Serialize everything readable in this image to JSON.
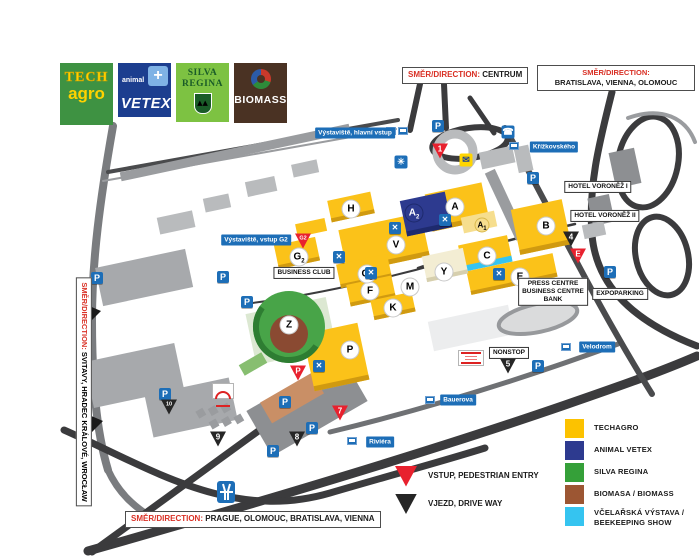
{
  "logos": {
    "techagro": {
      "line1": "TECH",
      "line2": "agro"
    },
    "vetex": {
      "small": "animal",
      "big": "VETEX",
      "cross": "+"
    },
    "silva": {
      "line1": "SILVA",
      "line2": "REGINA",
      "trees": "▲▲"
    },
    "biomass": {
      "text": "BIOMASS"
    }
  },
  "direction_signs": {
    "prefix": "SMĚR/DIRECTION:",
    "top_center": "CENTRUM",
    "top_right": "BRATISLAVA, VIENNA, OLOMOUC",
    "left": "SVITAVY, HRADEC KRÁLOVÉ, WROCŁAW",
    "bottom": "PRAGUE, OLOMOUC, BRATISLAVA, VIENNA"
  },
  "icon_glyphs": {
    "parking": "P",
    "restaurant": "✕",
    "first_aid": "✳",
    "post_office": "✉",
    "phone": "☎"
  },
  "map": {
    "street_labels": [
      {
        "text": "Výstaviště, hlavní vstup",
        "x": 355,
        "y": 133
      },
      {
        "text": "Křížkovského",
        "x": 554,
        "y": 147
      },
      {
        "text": "Výstaviště, vstup G2",
        "x": 256,
        "y": 240
      },
      {
        "text": "Velodrom",
        "x": 597,
        "y": 347
      },
      {
        "text": "Bauerova",
        "x": 458,
        "y": 400
      },
      {
        "text": "Riviéra",
        "x": 380,
        "y": 442
      }
    ],
    "poi_boxes": [
      {
        "id": "hotel-voronez-1",
        "lines": [
          "HOTEL VORONĚŽ I"
        ],
        "x": 598,
        "y": 187
      },
      {
        "id": "hotel-voronez-2",
        "lines": [
          "HOTEL VORONĚŽ II"
        ],
        "x": 605,
        "y": 216
      },
      {
        "id": "press-centre",
        "lines": [
          "PRESS CENTRE",
          "BUSINESS CENTRE",
          "BANK"
        ],
        "x": 553,
        "y": 292
      },
      {
        "id": "expoparking",
        "lines": [
          "EXPOPARKING"
        ],
        "x": 620,
        "y": 294
      },
      {
        "id": "business-club",
        "lines": [
          "BUSINESS CLUB"
        ],
        "x": 304,
        "y": 273
      },
      {
        "id": "nonstop",
        "lines": [
          "NONSTOP"
        ],
        "x": 509,
        "y": 353
      }
    ],
    "halls": [
      {
        "label": "A",
        "sub": "",
        "x": 455,
        "y": 207,
        "kind": "white"
      },
      {
        "label": "A",
        "sub": "1",
        "x": 482,
        "y": 225,
        "kind": "pale"
      },
      {
        "label": "A",
        "sub": "2",
        "x": 414,
        "y": 213,
        "kind": "blue"
      },
      {
        "label": "B",
        "sub": "",
        "x": 546,
        "y": 226,
        "kind": "white"
      },
      {
        "label": "C",
        "sub": "",
        "x": 487,
        "y": 256,
        "kind": "white"
      },
      {
        "label": "E",
        "sub": "",
        "x": 520,
        "y": 277,
        "kind": "white"
      },
      {
        "label": "F",
        "sub": "",
        "x": 370,
        "y": 291,
        "kind": "white"
      },
      {
        "label": "G",
        "sub": "1",
        "x": 367,
        "y": 274,
        "kind": "white"
      },
      {
        "label": "G",
        "sub": "2",
        "x": 299,
        "y": 257,
        "kind": "white"
      },
      {
        "label": "H",
        "sub": "",
        "x": 351,
        "y": 209,
        "kind": "white"
      },
      {
        "label": "K",
        "sub": "",
        "x": 393,
        "y": 308,
        "kind": "white"
      },
      {
        "label": "M",
        "sub": "",
        "x": 410,
        "y": 287,
        "kind": "white"
      },
      {
        "label": "V",
        "sub": "",
        "x": 396,
        "y": 245,
        "kind": "white"
      },
      {
        "label": "Y",
        "sub": "",
        "x": 444,
        "y": 272,
        "kind": "white"
      },
      {
        "label": "Z",
        "sub": "",
        "x": 289,
        "y": 325,
        "kind": "white"
      },
      {
        "label": "P",
        "sub": "",
        "x": 350,
        "y": 350,
        "kind": "white"
      }
    ],
    "entries_red": [
      {
        "label": "1",
        "x": 440,
        "y": 151
      },
      {
        "label": "G2",
        "x": 303,
        "y": 241
      },
      {
        "label": "E",
        "x": 578,
        "y": 256
      },
      {
        "label": "7",
        "x": 340,
        "y": 413
      },
      {
        "label": "P",
        "x": 298,
        "y": 373
      }
    ],
    "gates_black": [
      {
        "label": "4",
        "x": 571,
        "y": 239
      },
      {
        "label": "5",
        "x": 508,
        "y": 366
      },
      {
        "label": "8",
        "x": 297,
        "y": 439
      },
      {
        "label": "9",
        "x": 218,
        "y": 439
      },
      {
        "label": "10",
        "x": 169,
        "y": 407
      }
    ],
    "parkings": [
      {
        "x": 438,
        "y": 126
      },
      {
        "x": 533,
        "y": 178
      },
      {
        "x": 610,
        "y": 272
      },
      {
        "x": 223,
        "y": 277
      },
      {
        "x": 247,
        "y": 302
      },
      {
        "x": 97,
        "y": 278
      },
      {
        "x": 538,
        "y": 366
      },
      {
        "x": 165,
        "y": 394
      },
      {
        "x": 285,
        "y": 402
      },
      {
        "x": 312,
        "y": 428
      },
      {
        "x": 273,
        "y": 451
      }
    ],
    "restaurants": [
      {
        "x": 395,
        "y": 228
      },
      {
        "x": 445,
        "y": 220
      },
      {
        "x": 339,
        "y": 257
      },
      {
        "x": 371,
        "y": 273
      },
      {
        "x": 499,
        "y": 274
      },
      {
        "x": 319,
        "y": 366
      }
    ],
    "transit_stops": [
      {
        "x": 391,
        "y": 131
      },
      {
        "x": 403,
        "y": 131
      },
      {
        "x": 514,
        "y": 146
      },
      {
        "x": 279,
        "y": 240
      },
      {
        "x": 566,
        "y": 347
      },
      {
        "x": 430,
        "y": 400
      },
      {
        "x": 352,
        "y": 441
      }
    ]
  },
  "legend": {
    "items": [
      {
        "color": "#FCC200",
        "lines": [
          "TECHAGRO"
        ]
      },
      {
        "color": "#2D3A8F",
        "lines": [
          "ANIMAL VETEX"
        ]
      },
      {
        "color": "#35A039",
        "lines": [
          "SILVA REGINA"
        ]
      },
      {
        "color": "#9C5633",
        "lines": [
          "BIOMASA / BIOMASS"
        ]
      },
      {
        "color": "#35C4F0",
        "lines": [
          "VČELAŘSKÁ VÝSTAVA /",
          "BEEKEEPING SHOW"
        ]
      }
    ]
  },
  "entry_legend": [
    {
      "color": "#E8212E",
      "label": "VSTUP, PEDESTRIAN ENTRY"
    },
    {
      "color": "#262626",
      "label": "VJEZD, DRIVE WAY"
    }
  ],
  "colors": {
    "hall_yellow": "#FBC219",
    "vetex_blue": "#2D3A8F",
    "silva_green": "#35A039",
    "biomass_brown": "#9C5633",
    "bee_cyan": "#35C4F0",
    "sign_blue": "#1D6EB7",
    "entry_red": "#E8212E",
    "gate_black": "#262626"
  }
}
